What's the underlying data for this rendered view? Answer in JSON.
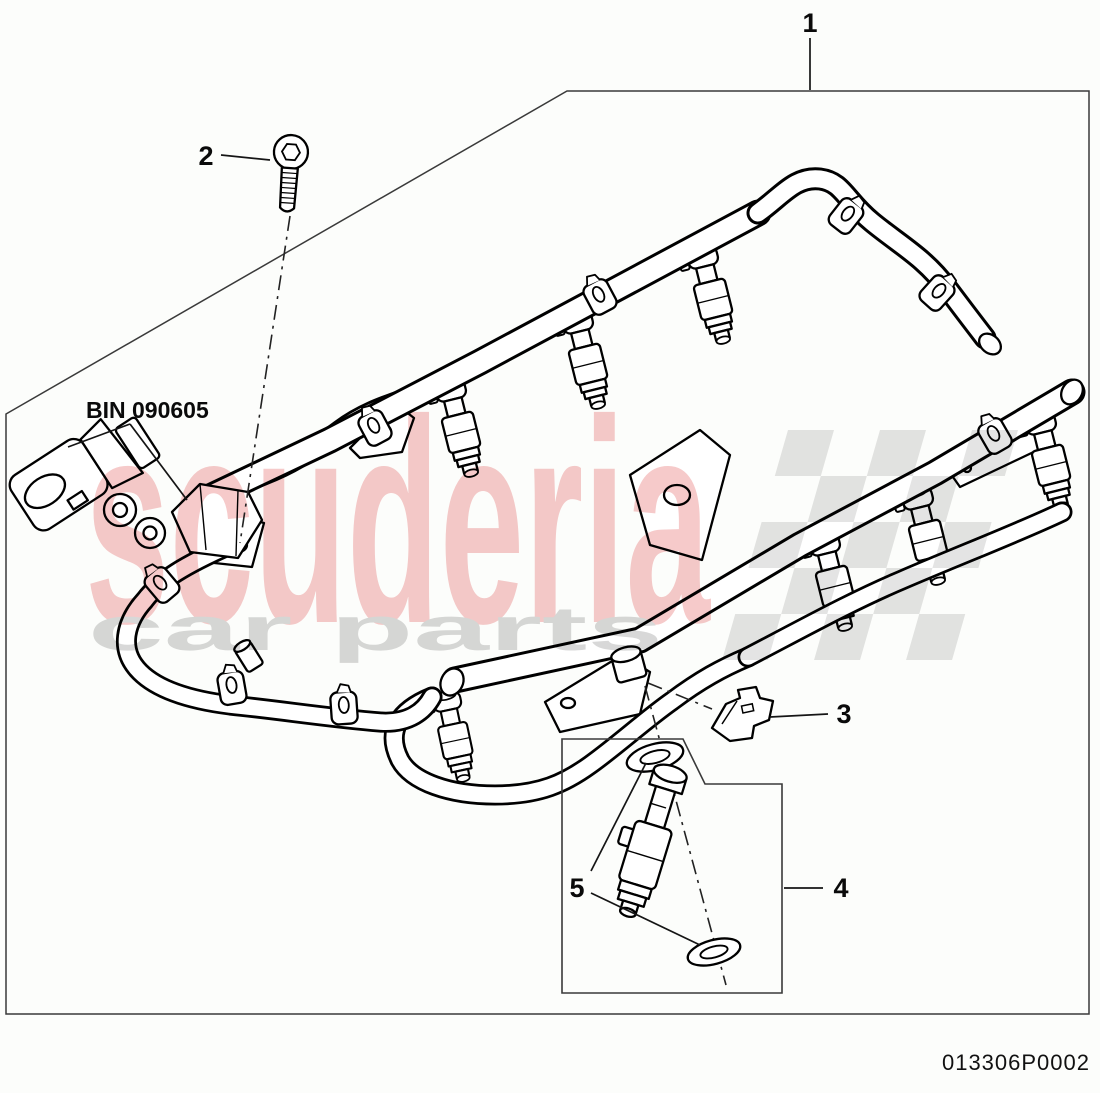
{
  "page": {
    "background": "#fcfdfb",
    "line_color": "#000000",
    "boundary_color": "#3a3a3a"
  },
  "diagram": {
    "callout_1": "1",
    "callout_2": "2",
    "callout_3": "3",
    "callout_4": "4",
    "callout_5": "5",
    "bin_label": "BIN 090605",
    "part_code": "013306P0002"
  },
  "watermark": {
    "brand": "scuderia",
    "subtext": "car parts",
    "brand_color": "#f6caca",
    "subtext_color": "#d8d8d8",
    "flag_color": "#e4e4e4"
  }
}
